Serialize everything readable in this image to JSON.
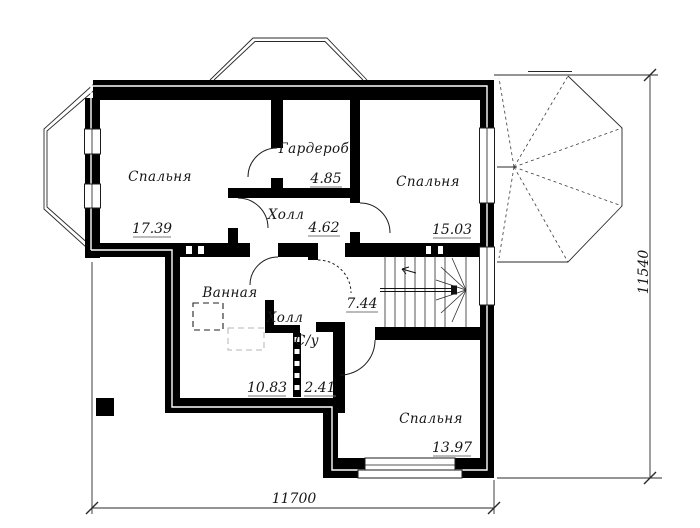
{
  "plan": {
    "title": "floor-plan-second-level",
    "rooms": {
      "bedroom1": {
        "label": "Спальня",
        "area": "17.39"
      },
      "wardrobe": {
        "label": "Гардероб",
        "area": "4.85"
      },
      "hall_upper": {
        "label": "Холл",
        "area": "4.62"
      },
      "bedroom2": {
        "label": "Спальня",
        "area": "15.03"
      },
      "bathroom": {
        "label": "Ванная",
        "area": "10.83"
      },
      "hall_lower": {
        "label": "Холл",
        "area": "7.44"
      },
      "wc": {
        "label": "С/у",
        "area": "2.41"
      },
      "bedroom3": {
        "label": "Спальня",
        "area": "13.97"
      }
    },
    "dimensions": {
      "width_mm": "11700",
      "height_mm": "11540"
    },
    "colors": {
      "wall": "#000000",
      "thin_line": "#1c1c1c",
      "background": "#ffffff",
      "faint": "#b5b5b5"
    }
  }
}
